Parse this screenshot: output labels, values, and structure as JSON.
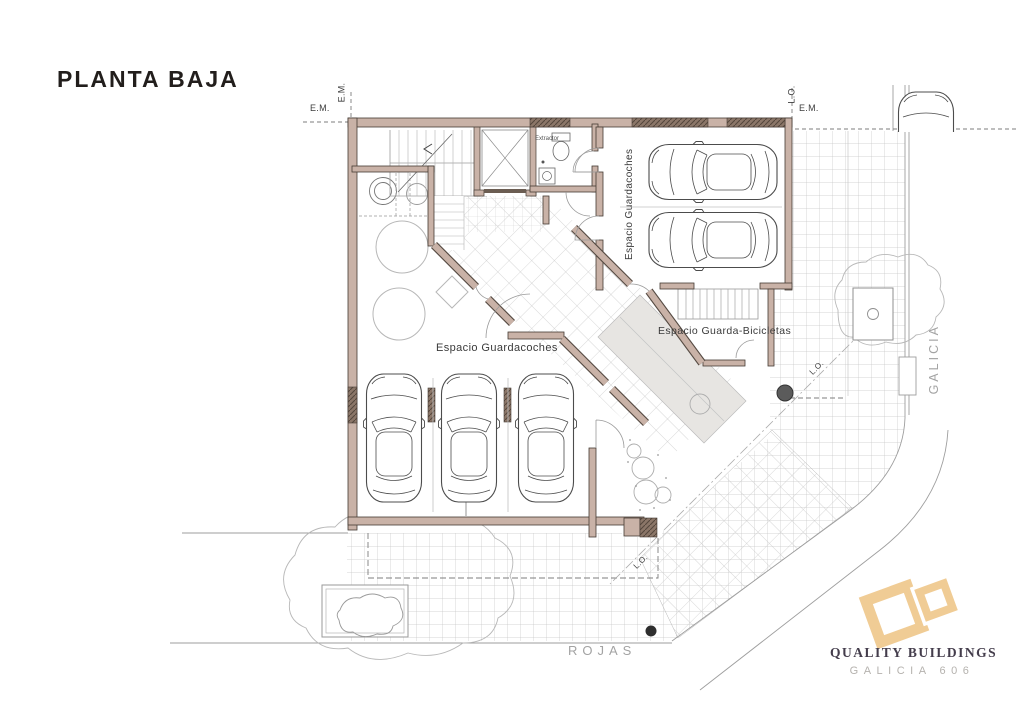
{
  "title": "PLANTA BAJA",
  "boundary_labels": {
    "em_left_horizontal": "E.M.",
    "em_left_vertical": "E.M.",
    "lo_right_vertical": "L.O.",
    "em_right_horizontal": "E.M.",
    "lo_diagonal_upper": "L.O.",
    "lo_diagonal_lower": "L.O."
  },
  "room_labels": {
    "garage_right": "Espacio Guardacoches",
    "garage_bottom": "Espacio Guardacoches",
    "bike_storage": "Espacio Guarda-Bicicletas",
    "extractor": "Extractor"
  },
  "streets": {
    "vertical": "GALICIA",
    "horizontal": "ROJAS"
  },
  "logo": {
    "company": "QUALITY BUILDINGS",
    "project": "GALICIA 606"
  },
  "colors": {
    "wall_fill": "#c9b2a7",
    "wall_outline": "#453b34",
    "wall_dark": "#8b7668",
    "logo_accent": "#f0cc95",
    "logo_text": "#443d4c",
    "street_text": "#a3a3a3",
    "tile_line": "#c6c6c6"
  }
}
